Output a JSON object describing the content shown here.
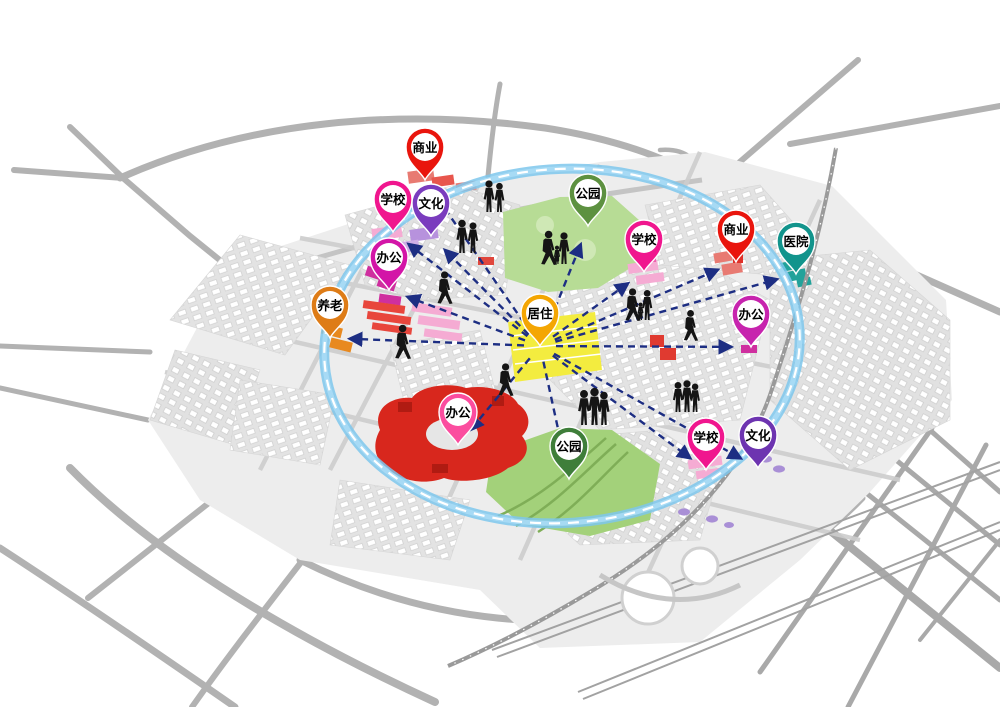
{
  "diagram": {
    "type": "urban-function-structure-map",
    "colors": {
      "ring": "#7ec7ec",
      "ring_dash": "#ffffff",
      "arrow": "#1d2e83",
      "road": "#b2b2b2",
      "ground": "#ededed",
      "people": "#151515"
    },
    "center_pin_id": "residence",
    "pins": [
      {
        "id": "commerce-top",
        "label": "商业",
        "color": "#e9150d",
        "x": 425,
        "y": 180
      },
      {
        "id": "school-topleft",
        "label": "学校",
        "color": "#f0168e",
        "x": 393,
        "y": 232
      },
      {
        "id": "culture-topleft",
        "label": "文化",
        "color": "#7a3cbe",
        "x": 431,
        "y": 236
      },
      {
        "id": "office-left",
        "label": "办公",
        "color": "#d315a7",
        "x": 389,
        "y": 290
      },
      {
        "id": "eldercare-left",
        "label": "养老",
        "color": "#de7c17",
        "x": 330,
        "y": 338
      },
      {
        "id": "residence",
        "label": "居住",
        "color": "#f4a603",
        "x": 540,
        "y": 346
      },
      {
        "id": "park-top",
        "label": "公园",
        "color": "#5d9140",
        "x": 588,
        "y": 226
      },
      {
        "id": "school-topright",
        "label": "学校",
        "color": "#f0168e",
        "x": 644,
        "y": 272
      },
      {
        "id": "commerce-right",
        "label": "商业",
        "color": "#e9150d",
        "x": 736,
        "y": 262
      },
      {
        "id": "hospital-right",
        "label": "医院",
        "color": "#12948c",
        "x": 796,
        "y": 274
      },
      {
        "id": "office-right",
        "label": "办公",
        "color": "#c724ae",
        "x": 751,
        "y": 347
      },
      {
        "id": "office-bottom",
        "label": "办公",
        "color": "#fb4d9f",
        "x": 458,
        "y": 445
      },
      {
        "id": "park-bottom",
        "label": "公园",
        "color": "#3f7e3a",
        "x": 569,
        "y": 479
      },
      {
        "id": "school-bottomright",
        "label": "学校",
        "color": "#f0168e",
        "x": 706,
        "y": 470
      },
      {
        "id": "culture-bottomright",
        "label": "文化",
        "color": "#6d34b0",
        "x": 758,
        "y": 468
      }
    ],
    "connections": [
      {
        "from": "residence",
        "to": "commerce-top"
      },
      {
        "from": "residence",
        "to": "school-topleft"
      },
      {
        "from": "residence",
        "to": "culture-topleft"
      },
      {
        "from": "residence",
        "to": "office-left"
      },
      {
        "from": "residence",
        "to": "eldercare-left"
      },
      {
        "from": "residence",
        "to": "park-top"
      },
      {
        "from": "residence",
        "to": "school-topright"
      },
      {
        "from": "residence",
        "to": "commerce-right"
      },
      {
        "from": "residence",
        "to": "hospital-right"
      },
      {
        "from": "residence",
        "to": "office-right"
      },
      {
        "from": "residence",
        "to": "office-bottom"
      },
      {
        "from": "residence",
        "to": "park-bottom"
      },
      {
        "from": "residence",
        "to": "school-bottomright"
      },
      {
        "from": "residence",
        "to": "culture-bottomright"
      }
    ],
    "figures": [
      {
        "type": "pair",
        "x": 489,
        "y": 212,
        "s": 0.95
      },
      {
        "type": "pair",
        "x": 462,
        "y": 253,
        "s": 1.0
      },
      {
        "type": "family",
        "x": 548,
        "y": 264,
        "s": 1.0
      },
      {
        "type": "walk",
        "x": 444,
        "y": 303,
        "s": 0.95
      },
      {
        "type": "walk",
        "x": 402,
        "y": 358,
        "s": 1.0
      },
      {
        "type": "walk",
        "x": 505,
        "y": 395,
        "s": 0.95
      },
      {
        "type": "trio",
        "x": 584,
        "y": 425,
        "s": 1.05
      },
      {
        "type": "family",
        "x": 632,
        "y": 320,
        "s": 0.95
      },
      {
        "type": "walk",
        "x": 690,
        "y": 340,
        "s": 0.9
      },
      {
        "type": "trio",
        "x": 678,
        "y": 412,
        "s": 0.9
      }
    ]
  }
}
